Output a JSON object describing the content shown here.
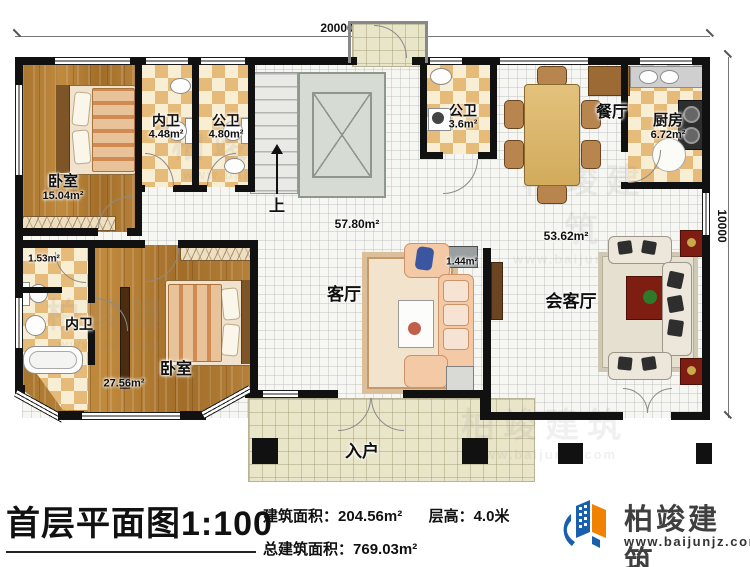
{
  "dimensions": {
    "width_label": "20000",
    "height_label": "10000"
  },
  "rooms": {
    "bedroom_top": {
      "name": "卧室",
      "area": "15.04m²"
    },
    "bath_inner_top": {
      "name": "内卫",
      "area": "4.48m²"
    },
    "bath_public_top": {
      "name": "公卫",
      "area": "4.80m²"
    },
    "bath_public_mid": {
      "name": "公卫",
      "area": "3.6m²"
    },
    "dining": {
      "name": "餐厅"
    },
    "kitchen": {
      "name": "厨房",
      "area": "6.72m²"
    },
    "hall": {
      "area": "57.80m²"
    },
    "stairs": {
      "name": "上"
    },
    "living": {
      "name": "客厅"
    },
    "tv_nook": {
      "area": "1.44m²"
    },
    "reception": {
      "name": "会客厅",
      "area": "53.62m²"
    },
    "bedroom_bottom": {
      "name": "卧室",
      "area": "27.56m²"
    },
    "bath_inner_bottom": {
      "name": "内卫"
    },
    "closet": {
      "area": "1.53m²"
    },
    "entry": {
      "name": "入户"
    }
  },
  "title_block": {
    "title": "首层平面图1:100",
    "building_area_label": "建筑面积：",
    "building_area_value": "204.56m²",
    "floor_height_label": "层高：",
    "floor_height_value": "4.0米",
    "total_area_label": "总建筑面积：",
    "total_area_value": "769.03m²"
  },
  "logo": {
    "name": "柏竣建筑",
    "website": "www.baijunjz.com"
  },
  "watermark": {
    "name": "柏竣建筑",
    "website": "www.baijunjz.com"
  },
  "colors": {
    "wall": "#111111",
    "wood": "#a9762f",
    "tile": "#e6ba79",
    "accent_blue": "#1a5fae",
    "accent_orange": "#ef8200"
  }
}
